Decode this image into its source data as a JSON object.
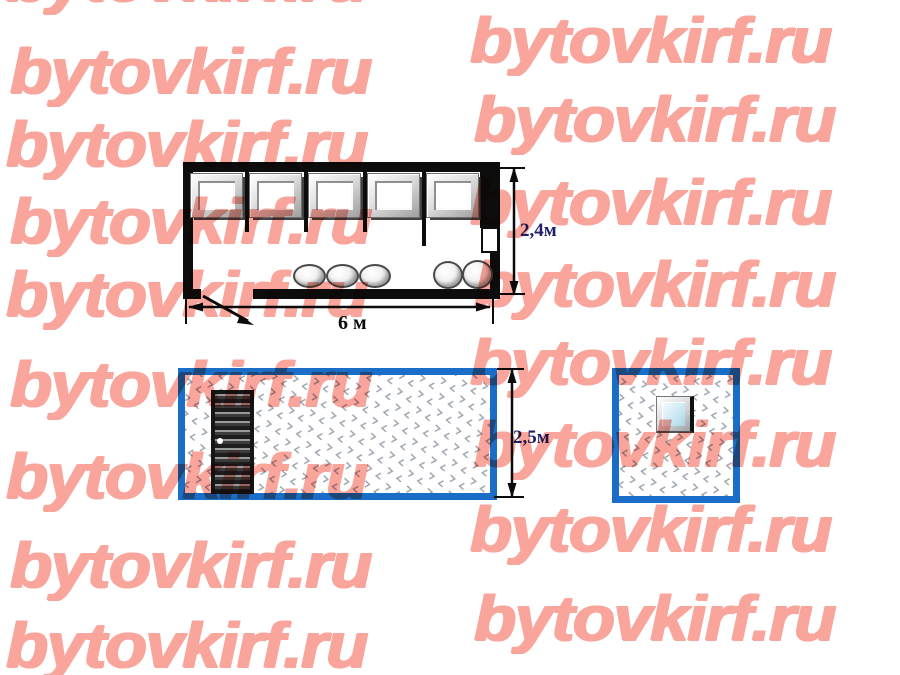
{
  "watermark": {
    "text": "bytovkirf.ru",
    "color": "#F9A59C",
    "rows": [
      {
        "x": 6,
        "y": -53
      },
      {
        "x": 10,
        "y": 39
      },
      {
        "x": 6,
        "y": 112
      },
      {
        "x": 10,
        "y": 189
      },
      {
        "x": 6,
        "y": 262
      },
      {
        "x": 10,
        "y": 352
      },
      {
        "x": 6,
        "y": 444
      },
      {
        "x": 10,
        "y": 533
      },
      {
        "x": 6,
        "y": 613
      },
      {
        "x": 470,
        "y": 8
      },
      {
        "x": 474,
        "y": 87
      },
      {
        "x": 470,
        "y": 170
      },
      {
        "x": 474,
        "y": 252
      },
      {
        "x": 470,
        "y": 330
      },
      {
        "x": 474,
        "y": 412
      },
      {
        "x": 470,
        "y": 497
      },
      {
        "x": 474,
        "y": 586
      }
    ]
  },
  "floor_plan": {
    "length_label": "6 м",
    "height_label": "2,4м",
    "window_count": 5,
    "stool_count": 5
  },
  "front_elevation": {
    "height_label": "2,5м"
  },
  "colors": {
    "walls": "#0d0d0d",
    "elevation_border": "#1B6EC8",
    "dimension_text": "#20206B",
    "watermark": "#F9A59C"
  }
}
